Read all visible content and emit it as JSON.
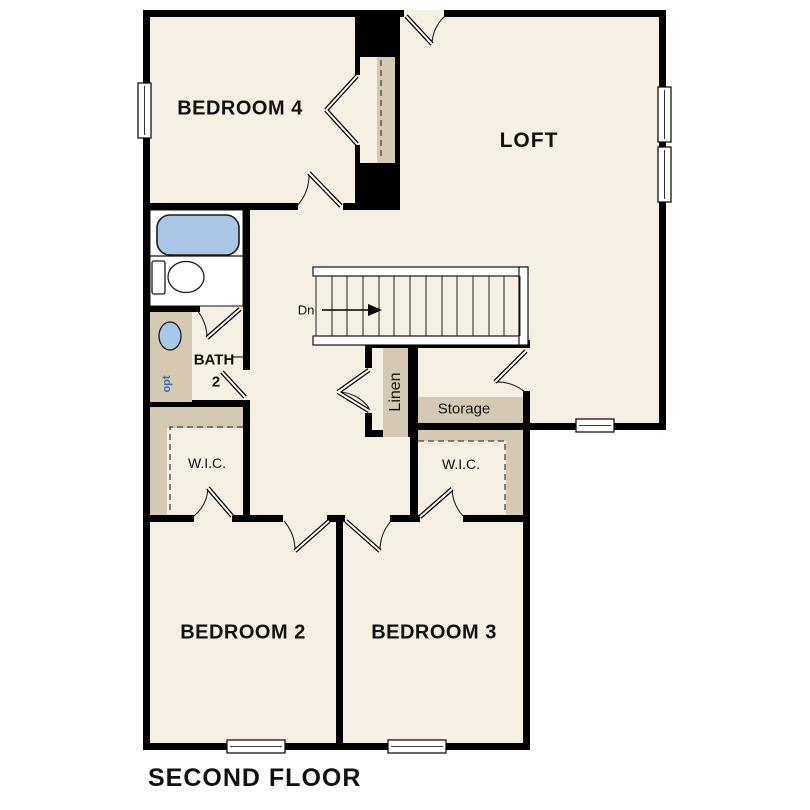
{
  "plan": {
    "title": "SECOND FLOOR",
    "rooms": {
      "bedroom4": "BEDROOM 4",
      "loft": "LOFT",
      "bath_line1": "BATH",
      "bath_line2": "2",
      "wic_left": "W.I.C.",
      "wic_right": "W.I.C.",
      "linen": "Linen",
      "storage": "Storage",
      "bedroom2": "BEDROOM 2",
      "bedroom3": "BEDROOM 3"
    },
    "stairs": {
      "direction_label": "Dn"
    },
    "markers": {
      "optional": "opt"
    },
    "colors": {
      "background": "#ffffff",
      "floor": "#f6efe4",
      "casework_tan": "#d6c9b3",
      "wall_black": "#000000",
      "fixture_blue": "#a9c7e6",
      "optional_blue": "#3a6ea5"
    }
  }
}
